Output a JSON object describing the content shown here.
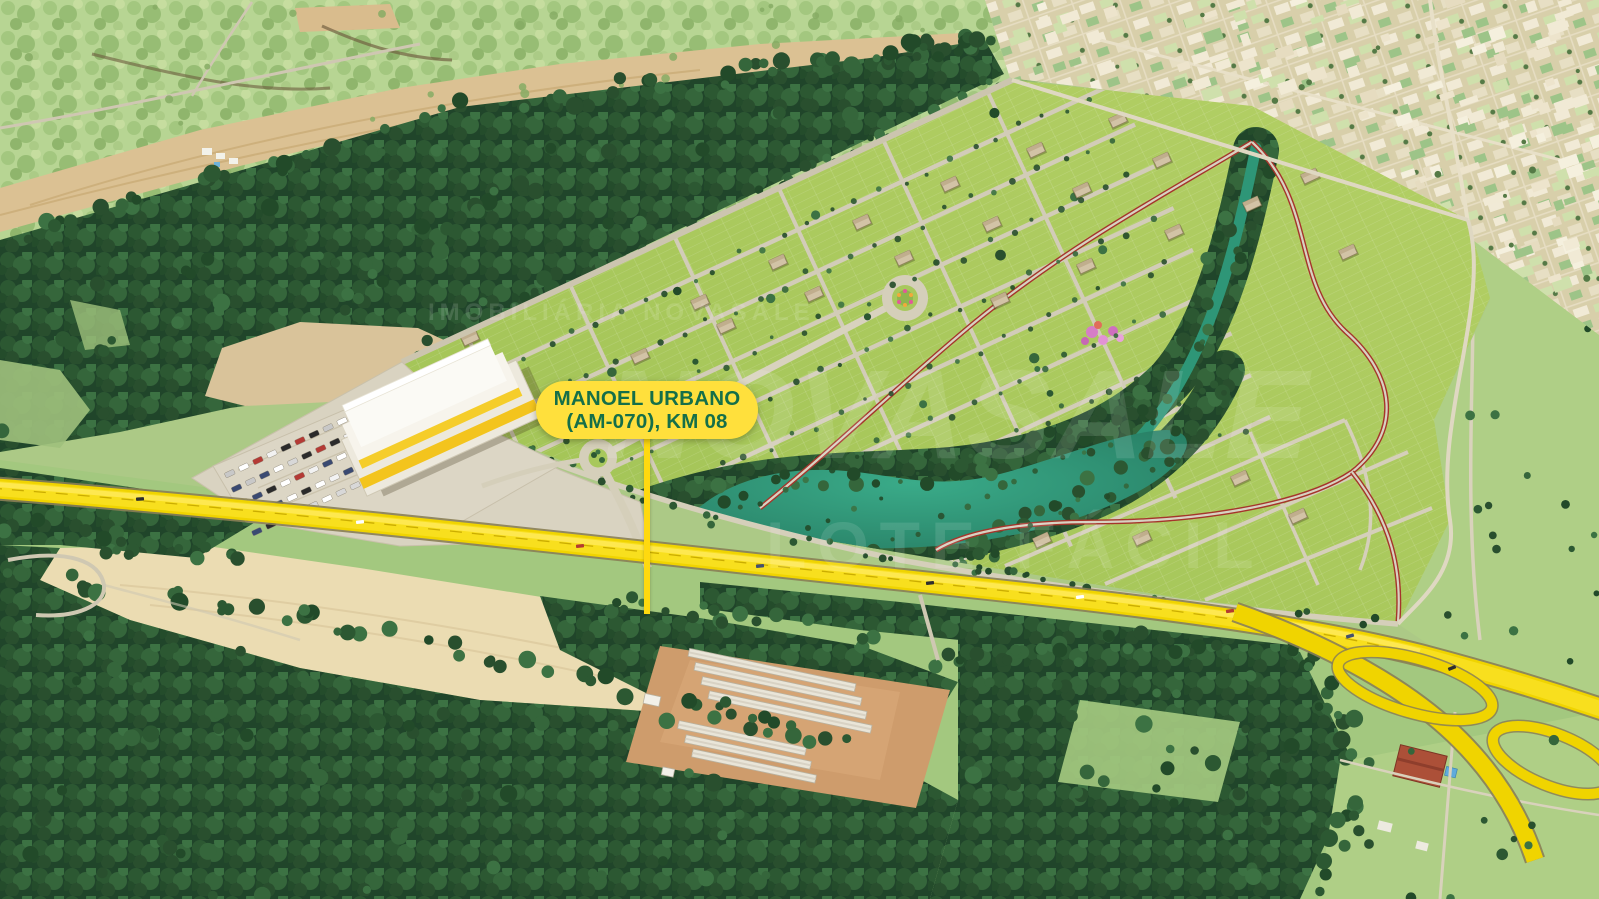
{
  "callout": {
    "line1": "MANOEL URBANO",
    "line2": "(AM-070), KM 08",
    "bg_color": "#FFE03C",
    "text_color": "#156F49"
  },
  "watermark": {
    "company": "IMOBILIÁRIA NOVASALE",
    "brand": "NOVASALE",
    "slogan": "LOTE FÁCIL",
    "color": "#FFFFFF"
  },
  "colors": {
    "highway_yellow": "#F0D400",
    "callout_yellow": "#FFE03C",
    "callout_text_green": "#156F49",
    "lake_teal": "#2E9677",
    "development_green": "#A8C85C",
    "forest_green": "#2C5832",
    "road_gray": "#D5CFBA",
    "town_tan": "#D8CFAA",
    "red_path": "#A5352B"
  }
}
